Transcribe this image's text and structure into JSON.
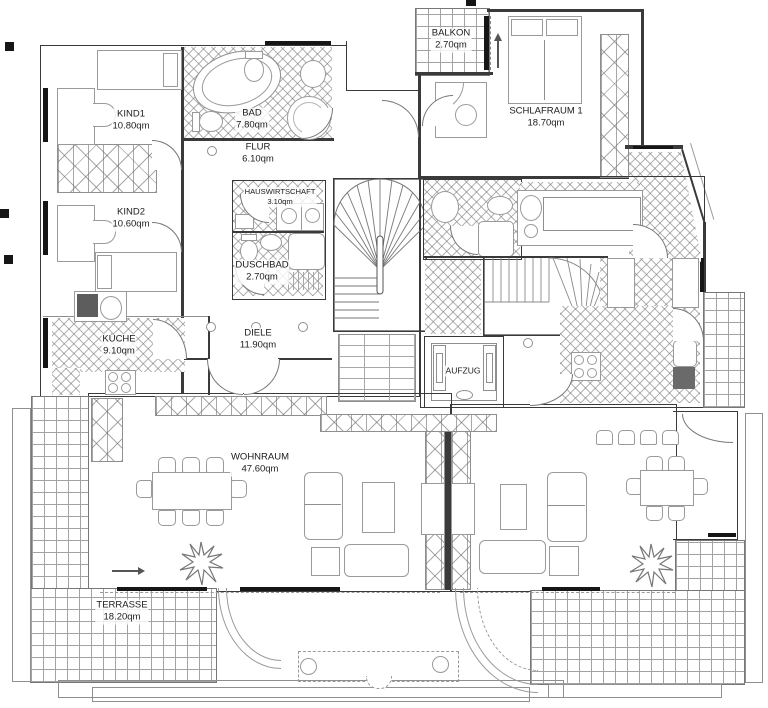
{
  "plan": {
    "rooms": {
      "kind1": {
        "name": "KIND1",
        "area": "10.80qm"
      },
      "kind2": {
        "name": "KIND2",
        "area": "10.60qm"
      },
      "bad": {
        "name": "BAD",
        "area": "7.80qm"
      },
      "flur": {
        "name": "FLUR",
        "area": "6.10qm"
      },
      "hauswirtschaft": {
        "name": "HAUSWIRTSCHAFT",
        "area": "3.10qm"
      },
      "duschbad": {
        "name": "DUSCHBAD",
        "area": "2.70qm"
      },
      "kueche": {
        "name": "KÜCHE",
        "area": "9.10qm"
      },
      "diele": {
        "name": "DIELE",
        "area": "11.90qm"
      },
      "wohnraum": {
        "name": "WOHNRAUM",
        "area": "47.60qm"
      },
      "terrasse": {
        "name": "TERRASSE",
        "area": "18.20qm"
      },
      "balkon": {
        "name": "BALKON",
        "area": "2.70qm"
      },
      "schlafraum1": {
        "name": "SCHLAFRAUM 1",
        "area": "18.70qm"
      },
      "aufzug": {
        "name": "AUFZUG"
      }
    },
    "colors": {
      "wall": "#3a3a3a",
      "line": "#8f8f8f",
      "text": "#1b1b1b",
      "background": "#ffffff"
    }
  }
}
